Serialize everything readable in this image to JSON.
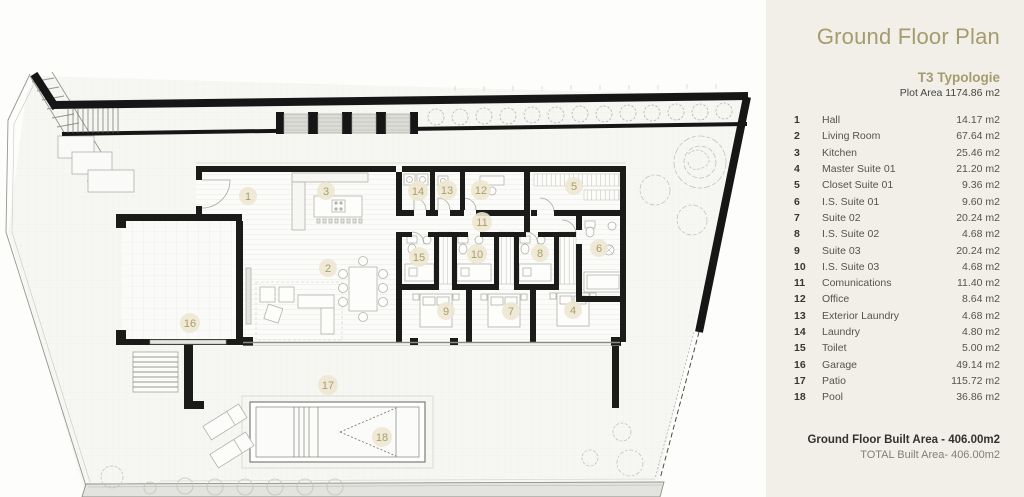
{
  "panel": {
    "title": "Ground Floor Plan",
    "typology": "T3 Typologie",
    "plot_area": "Plot Area 1174.86 m2",
    "rows": [
      {
        "num": "1",
        "name": "Hall",
        "area": "14.17 m2"
      },
      {
        "num": "2",
        "name": "Living Room",
        "area": "67.64 m2"
      },
      {
        "num": "3",
        "name": "Kitchen",
        "area": "25.46 m2"
      },
      {
        "num": "4",
        "name": "Master Suite 01",
        "area": "21.20 m2"
      },
      {
        "num": "5",
        "name": "Closet Suite 01",
        "area": "9.36 m2"
      },
      {
        "num": "6",
        "name": "I.S. Suite 01",
        "area": "9.60 m2"
      },
      {
        "num": "7",
        "name": "Suite 02",
        "area": "20.24 m2"
      },
      {
        "num": "8",
        "name": "I.S. Suite 02",
        "area": "4.68 m2"
      },
      {
        "num": "9",
        "name": "Suite 03",
        "area": "20.24 m2"
      },
      {
        "num": "10",
        "name": "I.S. Suite 03",
        "area": "4.68 m2"
      },
      {
        "num": "11",
        "name": "Comunications",
        "area": "11.40 m2"
      },
      {
        "num": "12",
        "name": "Office",
        "area": "8.64 m2"
      },
      {
        "num": "13",
        "name": "Exterior Laundry",
        "area": "4.68 m2"
      },
      {
        "num": "14",
        "name": "Laundry",
        "area": "4.80 m2"
      },
      {
        "num": "15",
        "name": "Toilet",
        "area": "5.00 m2"
      },
      {
        "num": "16",
        "name": "Garage",
        "area": "49.14 m2"
      },
      {
        "num": "17",
        "name": "Patio",
        "area": "115.72 m2"
      },
      {
        "num": "18",
        "name": "Pool",
        "area": "36.86 m2"
      }
    ],
    "footer": {
      "built_area": "Ground Floor Built Area - 406.00m2",
      "total_area": "TOTAL Built Area- 406.00m2"
    }
  },
  "plan": {
    "labels": [
      {
        "num": "1",
        "x": 248,
        "y": 196
      },
      {
        "num": "2",
        "x": 328,
        "y": 268
      },
      {
        "num": "3",
        "x": 326,
        "y": 191
      },
      {
        "num": "4",
        "x": 573,
        "y": 310
      },
      {
        "num": "5",
        "x": 574,
        "y": 186
      },
      {
        "num": "6",
        "x": 599,
        "y": 248
      },
      {
        "num": "7",
        "x": 511,
        "y": 311
      },
      {
        "num": "8",
        "x": 540,
        "y": 253
      },
      {
        "num": "9",
        "x": 446,
        "y": 311
      },
      {
        "num": "10",
        "x": 477,
        "y": 254
      },
      {
        "num": "11",
        "x": 482,
        "y": 222
      },
      {
        "num": "12",
        "x": 481,
        "y": 190
      },
      {
        "num": "13",
        "x": 447,
        "y": 190
      },
      {
        "num": "14",
        "x": 418,
        "y": 191
      },
      {
        "num": "15",
        "x": 419,
        "y": 257
      },
      {
        "num": "16",
        "x": 190,
        "y": 323
      },
      {
        "num": "17",
        "x": 328,
        "y": 385
      },
      {
        "num": "18",
        "x": 382,
        "y": 437
      }
    ]
  },
  "colors": {
    "accent_olive": "#a49c6e",
    "panel_bg": "#f2efe8",
    "wall_black": "#1b1b1a",
    "label_circle": "#ede7d2"
  }
}
